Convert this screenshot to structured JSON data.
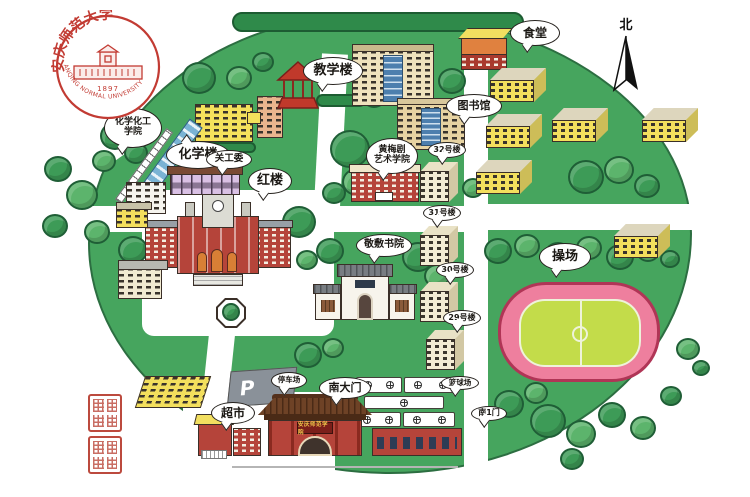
{
  "logo": {
    "zh": "安庆师范大学",
    "en": "ANQING NORMAL UNIVERSITY",
    "year": "1897"
  },
  "compass": {
    "north": "北"
  },
  "map_labels": {
    "chemistry_building": "化学楼",
    "teaching_building": "教学楼",
    "canteen": "食堂",
    "library": "图书馆",
    "chem_college": "化学化工\n学院",
    "ggw": "关工委",
    "red_building": "红楼",
    "huangmei_college": "黄梅剧\n艺术学院",
    "jingfu_academy": "敬敷书院",
    "dorm_32": "32号楼",
    "dorm_31": "31号楼",
    "dorm_30": "30号楼",
    "dorm_29": "29号楼",
    "playground": "操场",
    "basketball_court": "篮球场",
    "south_gate": "南大门",
    "south_gate_1": "南1门",
    "supermarket": "超市",
    "parking_lot": "停车场",
    "parking_sign": "P",
    "gate_plaque": "安庆师范学院"
  },
  "colors": {
    "campus_green": "#46a55e",
    "tree_green": "#3d9b57",
    "track_pink": "#ee7f9e",
    "field_green": "#c3dc4a",
    "building_yellow": "#f5e15c",
    "building_red": "#b5443a",
    "logo_red": "#c23b33",
    "road_white": "#ffffff"
  }
}
